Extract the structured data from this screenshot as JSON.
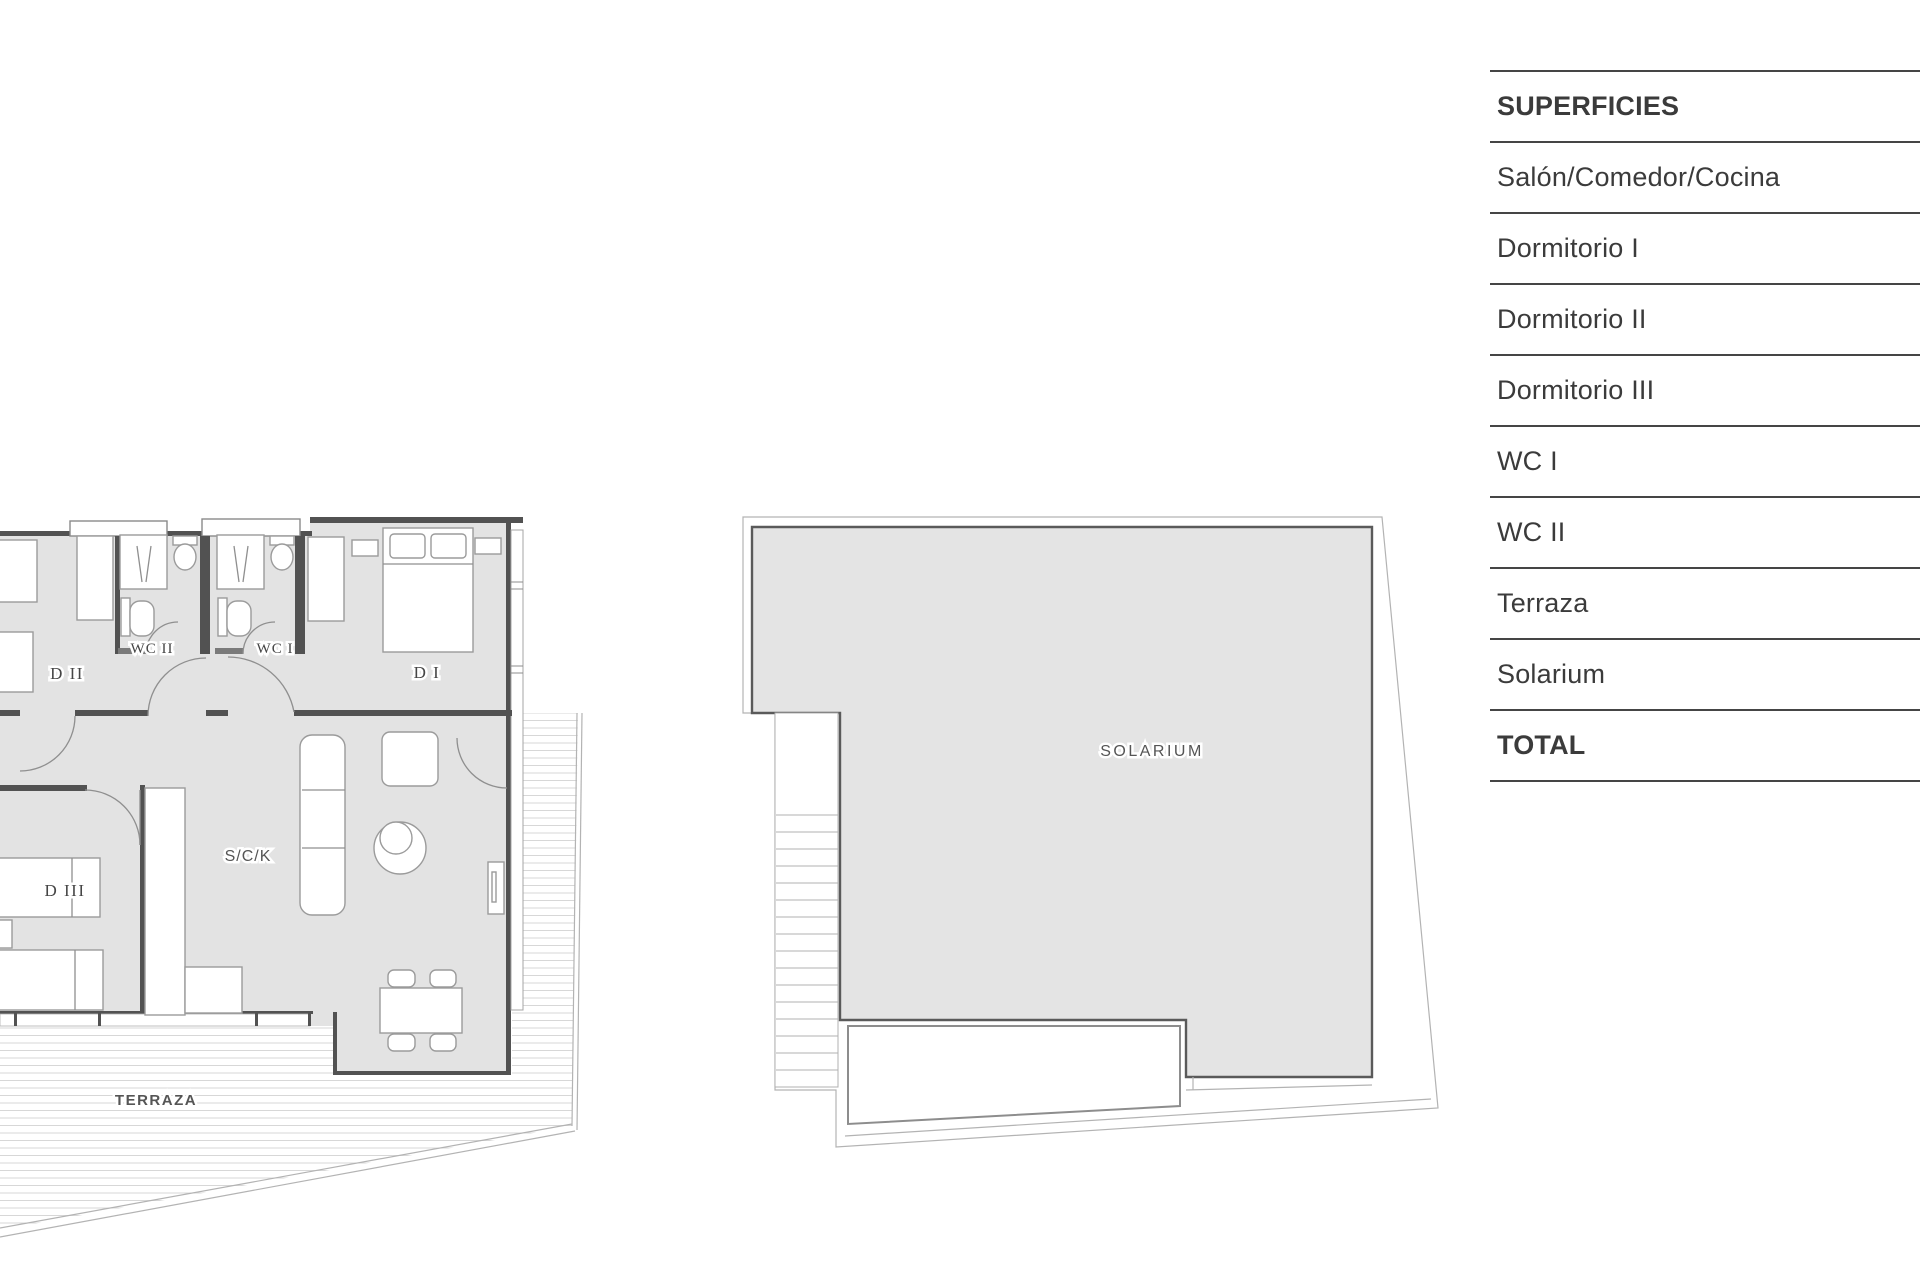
{
  "table": {
    "header": "SUPERFICIES",
    "rows": [
      "Salón/Comedor/Cocina",
      "Dormitorio I",
      "Dormitorio II",
      "Dormitorio III",
      "WC I",
      "WC II",
      "Terraza",
      "Solarium"
    ],
    "total_label": "TOTAL"
  },
  "floorplans": {
    "labels": {
      "d2": "D II",
      "wc2": "WC II",
      "wc1": "WC I",
      "d1": "D I",
      "d3": "D III",
      "sck": "S/C/K",
      "terraza": "TERRAZA",
      "solarium": "SOLARIUM"
    }
  },
  "colors": {
    "room_fill": "#e3e3e3",
    "wall": "#525252",
    "thin_line": "#b3b3b3",
    "table_line": "#454545",
    "text": "#3b3b3b"
  }
}
